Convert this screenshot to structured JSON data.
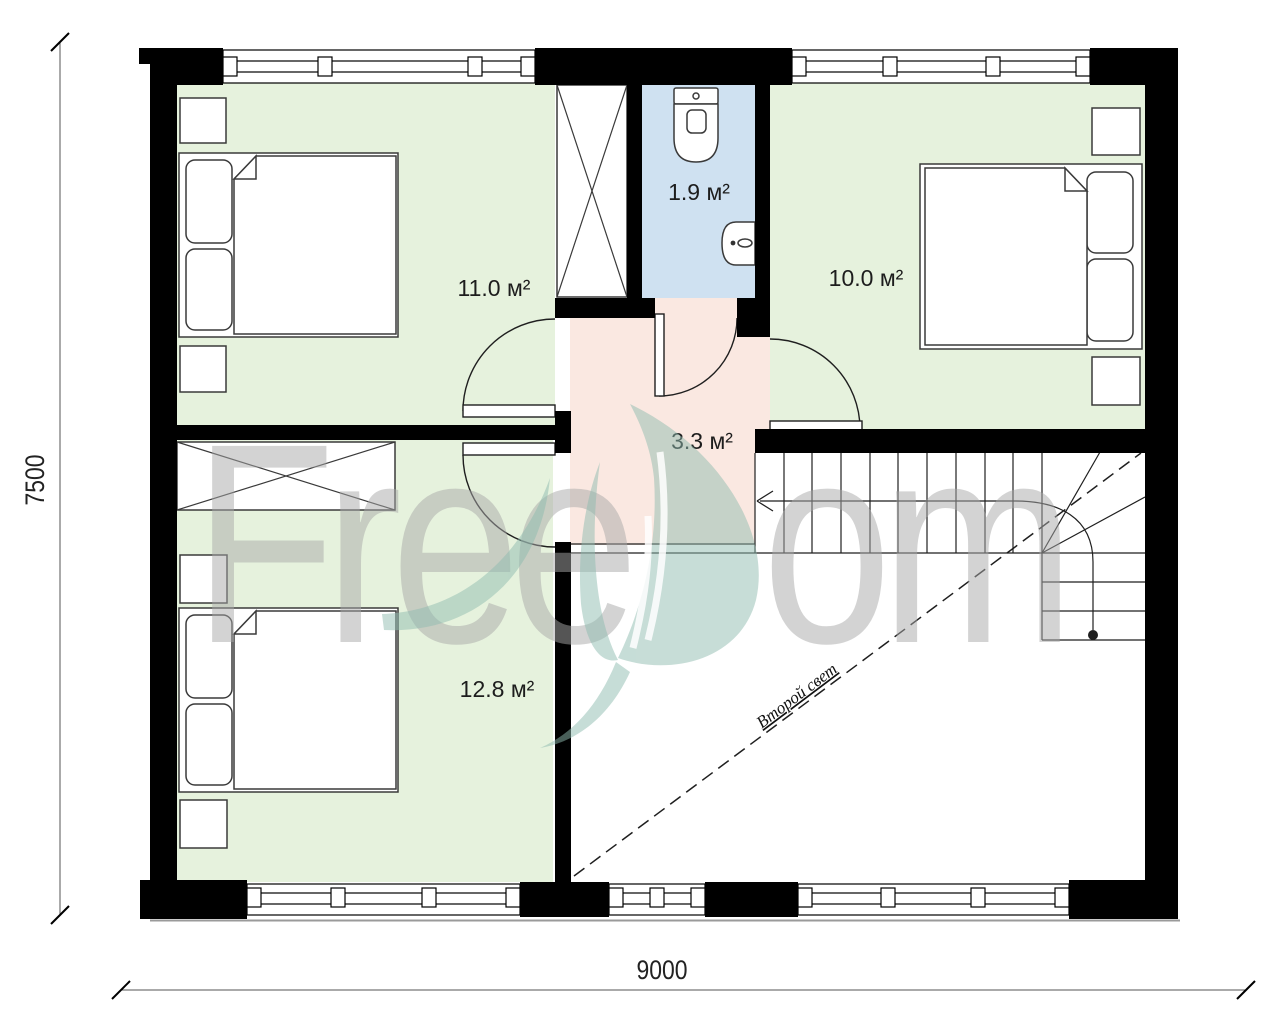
{
  "plan": {
    "dimensions": {
      "bottom_label": "9000",
      "left_label": "7500"
    },
    "rooms": [
      {
        "name": "bedroom-top-left",
        "area_label": "11.0 м²"
      },
      {
        "name": "bathroom",
        "area_label": "1.9 м²"
      },
      {
        "name": "bedroom-top-right",
        "area_label": "10.0 м²"
      },
      {
        "name": "hallway",
        "area_label": "3.3 м²"
      },
      {
        "name": "bedroom-bottom-left",
        "area_label": "12.8 м²"
      },
      {
        "name": "double-height-void",
        "area_label": "Второй свет"
      }
    ],
    "watermark": {
      "left": "Free",
      "right": "om"
    },
    "colors": {
      "wall": "#000000",
      "room_green": "#e6f2dd",
      "bathroom_blue": "#cfe1f1",
      "hallway_pink": "#fae8e1",
      "line": "#3a3a3a",
      "watermark_gray": "#a9a9a9",
      "watermark_teal": "#8fbcb0",
      "dim": "#222222"
    }
  }
}
